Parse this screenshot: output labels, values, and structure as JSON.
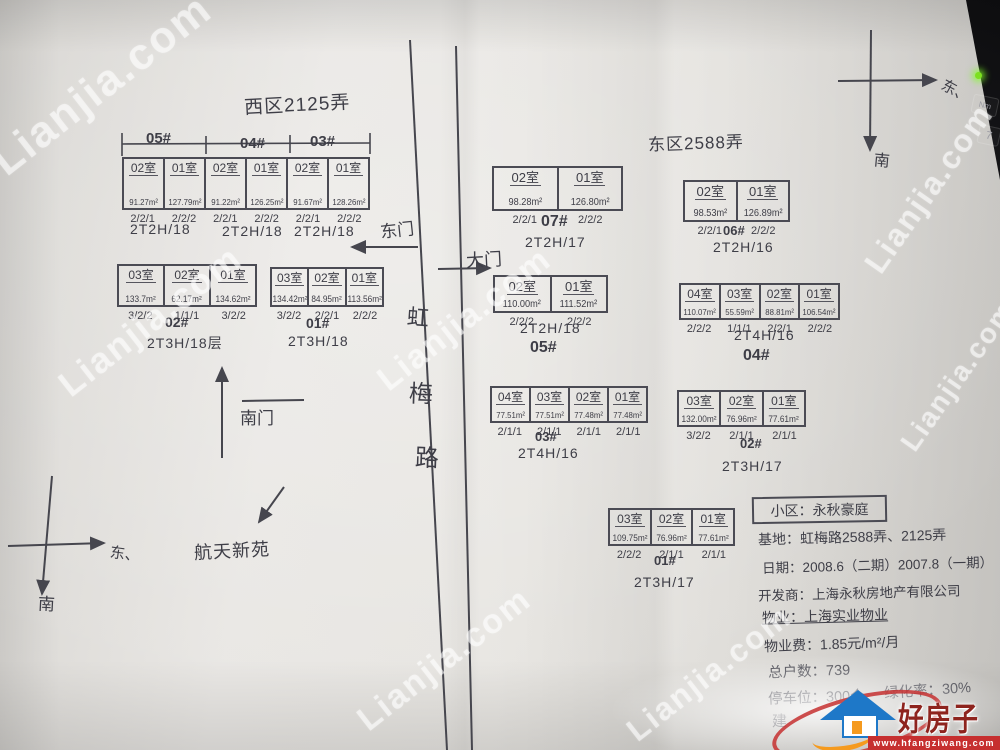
{
  "west": {
    "title": "西区2125弄",
    "strip": {
      "sections": [
        "05#",
        "04#",
        "03#"
      ],
      "cells": [
        {
          "room": "02室",
          "area": "91.27m²",
          "spec": "2/2/1"
        },
        {
          "room": "01室",
          "area": "127.79m²",
          "spec": "2/2/2"
        },
        {
          "room": "02室",
          "area": "91.22m²",
          "spec": "2/2/1"
        },
        {
          "room": "01室",
          "area": "126.25m²",
          "spec": "2/2/2"
        },
        {
          "room": "02室",
          "area": "91.67m²",
          "spec": "2/2/1"
        },
        {
          "room": "01室",
          "area": "128.26m²",
          "spec": "2/2/2"
        }
      ],
      "types": [
        "2T2H/18",
        "2T2H/18",
        "2T2H/18"
      ]
    },
    "block02": {
      "label": "02#",
      "type": "2T3H/18层",
      "cells": [
        {
          "room": "03室",
          "area": "133.7m²",
          "spec": "3/2/2"
        },
        {
          "room": "02室",
          "area": "62.17m²",
          "spec": "1/1/1"
        },
        {
          "room": "01室",
          "area": "134.62m²",
          "spec": "3/2/2"
        }
      ]
    },
    "block01": {
      "label": "01#",
      "type": "2T3H/18",
      "cells": [
        {
          "room": "03室",
          "area": "134.42m²",
          "spec": "3/2/2"
        },
        {
          "room": "02室",
          "area": "84.95m²",
          "spec": "2/2/1"
        },
        {
          "room": "01室",
          "area": "113.56m²",
          "spec": "2/2/2"
        }
      ]
    }
  },
  "east": {
    "title": "东区2588弄",
    "block07": {
      "label": "07#",
      "type": "2T2H/17",
      "cells": [
        {
          "room": "02室",
          "area": "98.28m²",
          "spec": "2/2/1"
        },
        {
          "room": "01室",
          "area": "126.80m²",
          "spec": "2/2/2"
        }
      ]
    },
    "block06": {
      "label": "06#",
      "type": "2T2H/16",
      "cells": [
        {
          "room": "02室",
          "area": "98.53m²",
          "spec": "2/2/1"
        },
        {
          "room": "01室",
          "area": "126.89m²",
          "spec": "2/2/2"
        }
      ]
    },
    "block05": {
      "label": "05#",
      "type": "2T2H/18",
      "cells": [
        {
          "room": "02室",
          "area": "110.00m²",
          "spec": "2/2/2"
        },
        {
          "room": "01室",
          "area": "111.52m²",
          "spec": "2/2/2"
        }
      ]
    },
    "block04": {
      "label": "04#",
      "type": "2T4H/16",
      "cells": [
        {
          "room": "04室",
          "area": "110.07m²",
          "spec": "2/2/2"
        },
        {
          "room": "03室",
          "area": "55.59m²",
          "spec": "1/1/1"
        },
        {
          "room": "02室",
          "area": "88.81m²",
          "spec": "2/2/1"
        },
        {
          "room": "01室",
          "area": "106.54m²",
          "spec": "2/2/2"
        }
      ]
    },
    "block03": {
      "label": "03#",
      "type": "2T4H/16",
      "cells": [
        {
          "room": "04室",
          "area": "77.51m²",
          "spec": "2/1/1"
        },
        {
          "room": "03室",
          "area": "77.51m²",
          "spec": "2/1/1"
        },
        {
          "room": "02室",
          "area": "77.48m²",
          "spec": "2/1/1"
        },
        {
          "room": "01室",
          "area": "77.48m²",
          "spec": "2/1/1"
        }
      ]
    },
    "block02": {
      "label": "02#",
      "type": "2T3H/17",
      "cells": [
        {
          "room": "03室",
          "area": "132.00m²",
          "spec": "3/2/2"
        },
        {
          "room": "02室",
          "area": "76.96m²",
          "spec": "2/1/1"
        },
        {
          "room": "01室",
          "area": "77.61m²",
          "spec": "2/1/1"
        }
      ]
    },
    "block01": {
      "label": "01#",
      "type": "2T3H/17",
      "cells": [
        {
          "room": "03室",
          "area": "109.75m²",
          "spec": "2/2/2"
        },
        {
          "room": "02室",
          "area": "76.96m²",
          "spec": "2/1/1"
        },
        {
          "room": "01室",
          "area": "77.61m²",
          "spec": "2/1/1"
        }
      ]
    }
  },
  "map": {
    "road_chars": [
      "虹",
      "梅",
      "路"
    ],
    "east_gate": "东门",
    "main_gate": "大门",
    "south_gate": "南门",
    "landmark": "航天新苑",
    "compass": {
      "east": "东、",
      "south": "南"
    }
  },
  "info": {
    "title": "小区：永秋豪庭",
    "address": "基地：虹梅路2588弄、2125弄",
    "date": "日期：2008.6（二期）2007.8（一期）",
    "developer": "开发商：上海永秋房地产有限公司",
    "property_mgmt": "物业：上海实业物业",
    "property_fee": "物业费：1.85元/m²/月",
    "total_units": "总户数：739",
    "parking": "停车位：300个",
    "greening": "绿化率：30%",
    "partial_line": "建"
  },
  "photo": {
    "watermark": "Lianjia.com",
    "logo_name": "好房子网",
    "logo_url": "www.hfangziwang.com",
    "desk_key_1": "Nm",
    "desk_key_2": "7"
  }
}
